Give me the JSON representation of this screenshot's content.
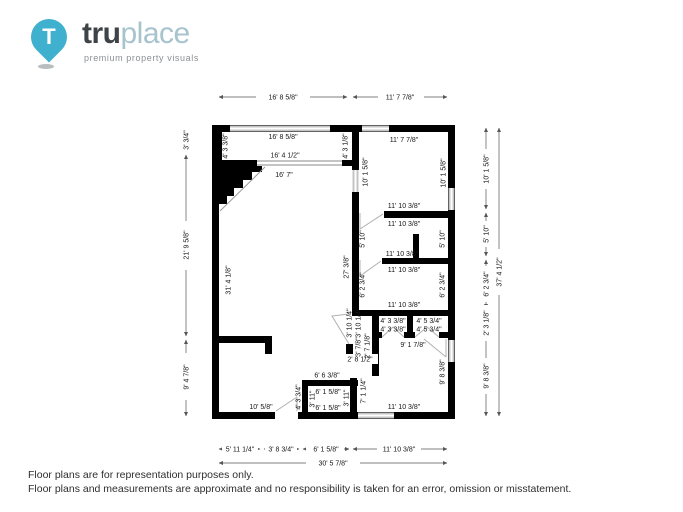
{
  "logo": {
    "brand_bold": "tru",
    "brand_light": "place",
    "tagline": "premium property visuals",
    "pin_letter": "T",
    "colors": {
      "teal": "#3fb0cd",
      "dark": "#3e4347",
      "light": "#a7c4ce"
    }
  },
  "dims": {
    "top": [
      "16' 8 5/8\"",
      "11' 7 7/8\""
    ],
    "left": [
      "3' 3/4\"",
      "21' 9 5/8\"",
      "9' 4 7/8\""
    ],
    "right": [
      "10' 1 5/8\"",
      "5' 10\"",
      "6' 2 3/4\"",
      "2' 3 1/8\"",
      "9' 8 3/8\""
    ],
    "right_total": "37' 4 1/2\"",
    "bottom": [
      "5' 11 1/4\"",
      "3' 8 3/4\"",
      "6' 1 5/8\"",
      "11' 10 3/8\""
    ],
    "bottom_total": "30' 5 7/8\""
  },
  "rooms": {
    "foyer": {
      "top": "16' 8 5/8\"",
      "left": "4' 3 3/8\"",
      "right": "4' 3 1/8\"",
      "bottom": "16' 4 1/2\""
    },
    "living": {
      "top": "16' 7\"",
      "left": "31' 4 1/8\"",
      "right": "27' 3/8\"",
      "bottom": "10' 5/8\""
    },
    "bedroom1": {
      "top": "11' 7 7/8\"",
      "left": "10' 1 5/8\"",
      "right": "10' 1 5/8\""
    },
    "room2": {
      "above": "11' 10 3/8\"",
      "top": "11' 10 3/8\"",
      "left": "5' 10\"",
      "right": "5' 10\"",
      "bottom": "11' 10 3/8\""
    },
    "room3": {
      "top": "11' 10 3/8\"",
      "left": "6' 2 3/4\"",
      "right": "6' 2 3/4\"",
      "bottom": "11' 10 3/8\""
    },
    "closet_left": {
      "top": "4' 3 3/8\"",
      "bottom": "4' 3 3/8\""
    },
    "closet_right": {
      "top": "4' 5 3/4\"",
      "bottom": "4' 5 3/4\""
    },
    "hall": {
      "corridor": "9' 1 7/8\"",
      "v1": "3' 10 1/4\"",
      "v2": "3' 10 1/4\"",
      "v3": "3' 7/8\"",
      "v4": "2' 7 1/8\"",
      "h1": "2' 8 1/2\""
    },
    "bedroom2": {
      "right": "9' 8 3/8\"",
      "bottom": "11' 10 3/8\""
    },
    "laundry": {
      "top_out": "6' 6 3/8\"",
      "top": "6' 1 5/8\"",
      "bottom": "6' 1 5/8\"",
      "left_out": "4' 3 3/4\"",
      "left": "3' 11\"",
      "right": "3' 11\"",
      "right_out": "7' 1 1/4\""
    }
  },
  "footer": {
    "line1": "Floor plans are for representation purposes only.",
    "line2": "Floor plans and measurements are approximate and no responsibility is taken for an error, omission or misstatement."
  }
}
